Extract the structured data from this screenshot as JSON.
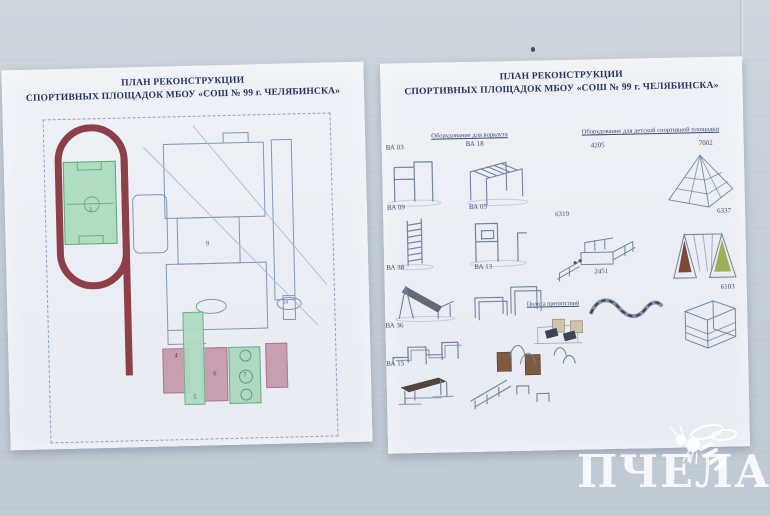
{
  "posters": {
    "left": {
      "title_line1": "ПЛАН РЕКОНСТРУКЦИИ",
      "title_line2": "СПОРТИВНЫХ ПЛОЩАДОК МБОУ «СОШ № 99 г. ЧЕЛЯБИНСКА»",
      "plan": {
        "field_number": "3",
        "building_number": "9",
        "room_number": "10",
        "courts": [
          "4",
          "5",
          "6",
          "7"
        ]
      }
    },
    "right": {
      "title_line1": "ПЛАН РЕКОНСТРУКЦИИ",
      "title_line2": "СПОРТИВНЫХ ПЛОЩАДОК МБОУ «СОШ № 99 г. ЧЕЛЯБИНСКА»",
      "workout": {
        "heading": "Оборудование для воркаута",
        "items": [
          "ВА 03",
          "ВА 18",
          "ВА 09",
          "ВА 05",
          "ВА 38",
          "ВА 13",
          "ВА 36",
          "ВА 15"
        ]
      },
      "kids": {
        "heading": "Оборудование для детской спортивной площадки",
        "items": [
          "4205",
          "7002",
          "6319",
          "6337",
          "2451",
          "6103"
        ]
      },
      "obstacle": {
        "heading": "Полоса препятствий"
      }
    }
  },
  "watermark": {
    "text": "ПЧЕЛА"
  },
  "colors": {
    "track": "#8d404a",
    "field_green": "#b0dcc2",
    "court_pink": "#c89fb0",
    "plan_line": "#8197b9",
    "drawing_line": "#74859f",
    "wall": "#c6cfd8"
  }
}
